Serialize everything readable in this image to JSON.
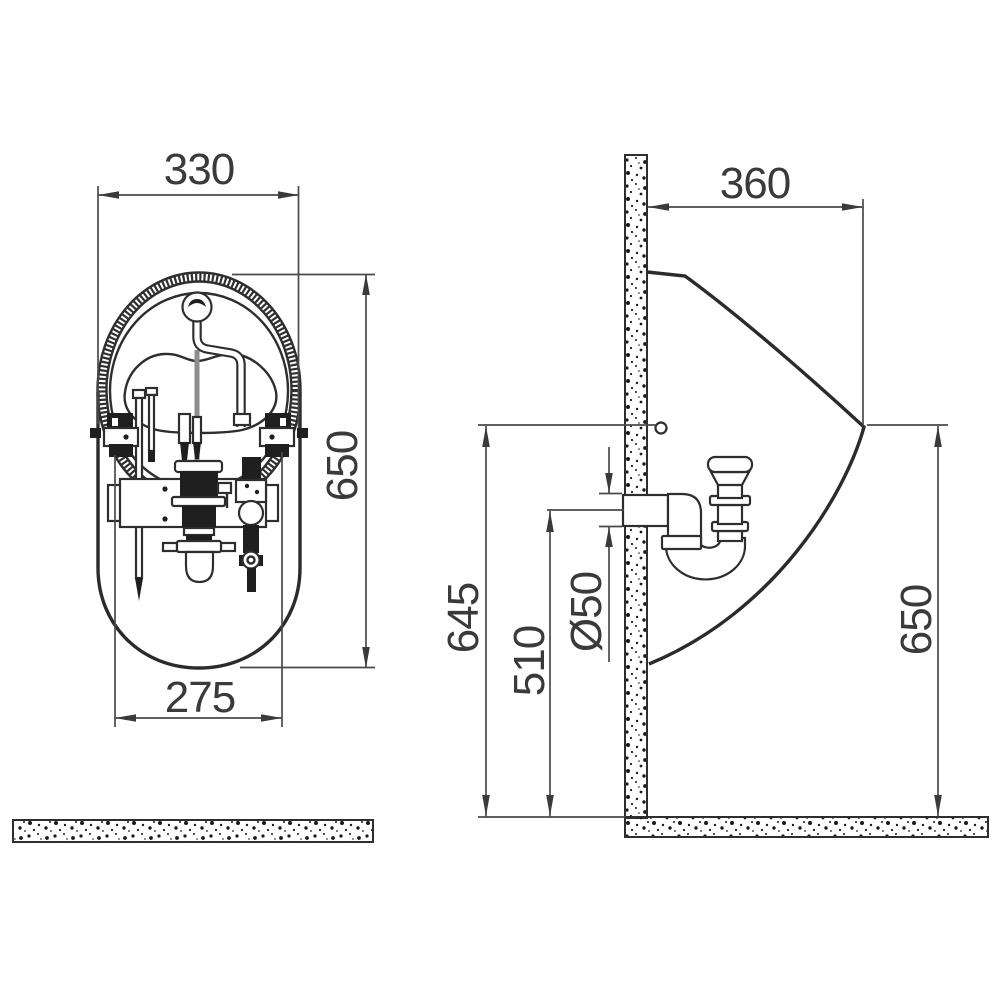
{
  "drawing": {
    "type": "sanitary-fixture-installation-diagram",
    "front_view": {
      "width_top": "330",
      "height": "650",
      "width_bottom": "275"
    },
    "side_view": {
      "depth": "360",
      "fixing_height": "645",
      "outlet_height": "510",
      "outlet_diameter": "Ø50",
      "rim_height": "650"
    },
    "colors": {
      "line": "#2e2e2e",
      "dimension_line": "#4a4a4a",
      "text": "#3a3a3a",
      "background": "#ffffff"
    }
  }
}
